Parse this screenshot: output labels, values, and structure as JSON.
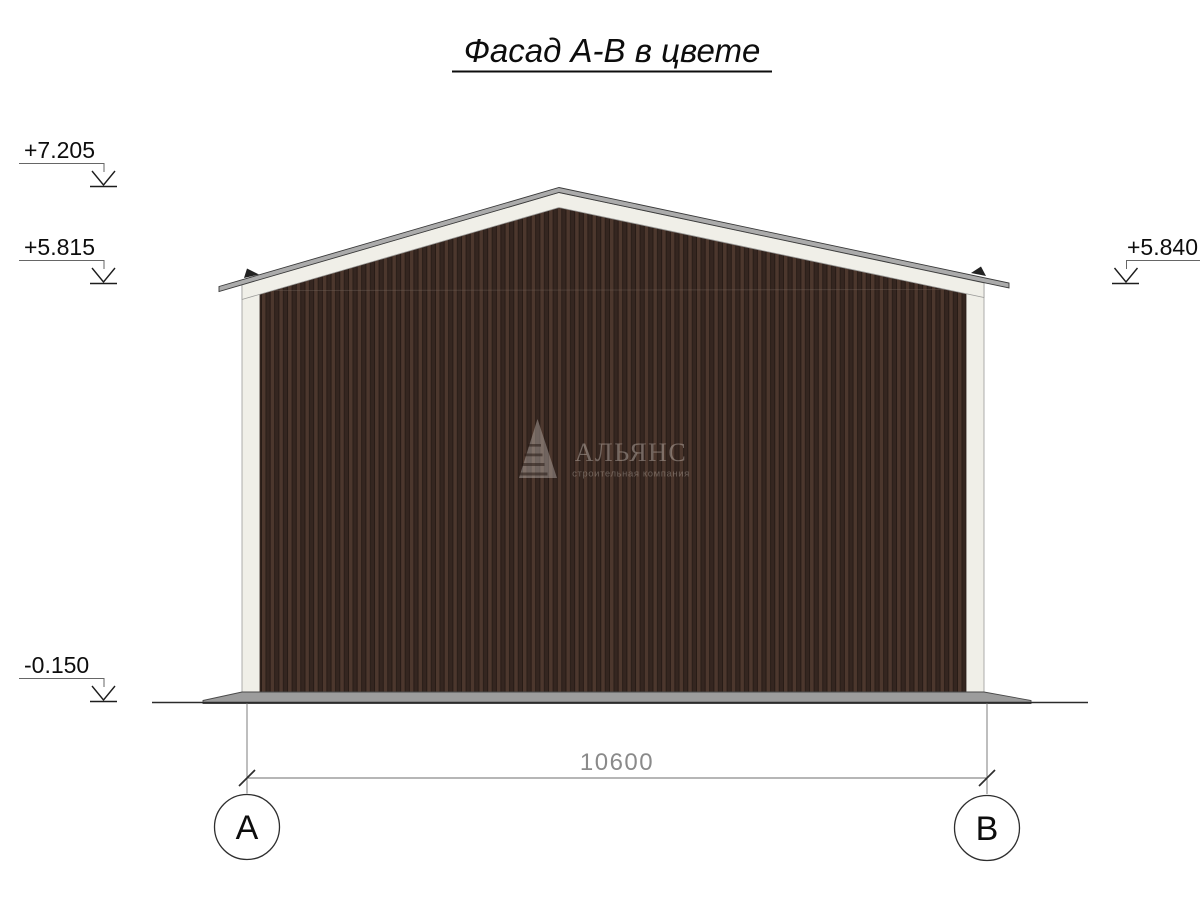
{
  "title": {
    "text": "Фасад А-В в цвете"
  },
  "elevation_marks": [
    {
      "id": "ridge",
      "value": "+7.205"
    },
    {
      "id": "left-eave",
      "value": "+5.815"
    },
    {
      "id": "right-eave",
      "value": "+5.840"
    },
    {
      "id": "ground",
      "value": "-0.150"
    }
  ],
  "dimension": {
    "value": "10600"
  },
  "axes": [
    {
      "label": "А"
    },
    {
      "label": "В"
    }
  ],
  "watermark": {
    "name": "АЛЬЯНС",
    "tagline": "строительная компания"
  },
  "colors": {
    "siding_face": "#4c372d",
    "siding_shadow": "#352620",
    "siding_line": "#251a15",
    "trim": "#f0efe8",
    "roof_edge": "#ababab",
    "foundation": "#9c9c9c",
    "lines": "#2e2e2e",
    "dimension_text": "#8a8a8a"
  }
}
